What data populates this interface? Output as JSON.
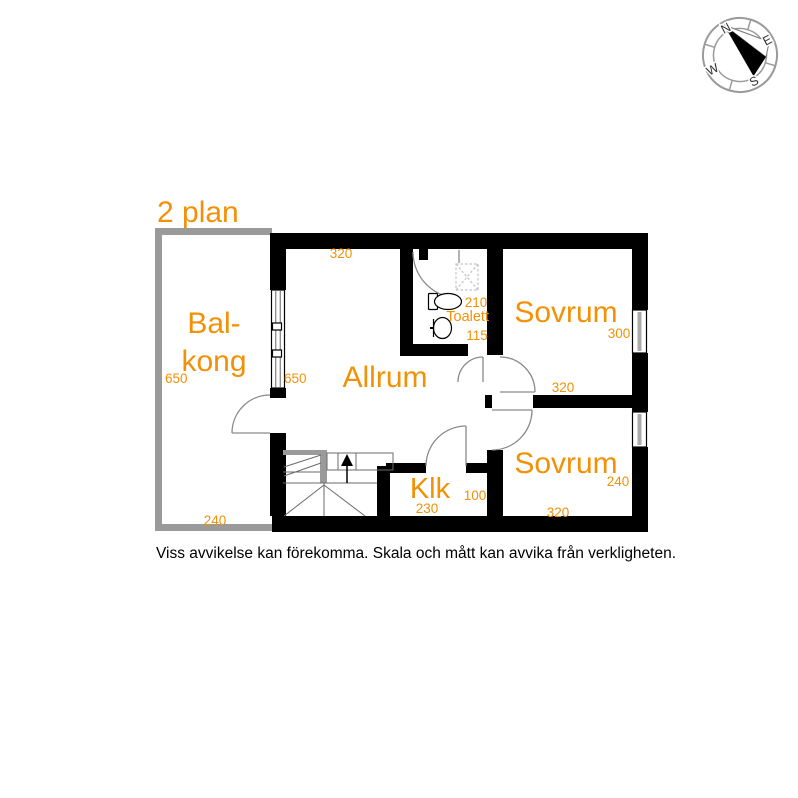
{
  "title": "2 plan",
  "disclaimer": "Viss avvikelse kan förekomma. Skala och mått kan avvika från verkligheten.",
  "compass": {
    "north": "N",
    "east": "E",
    "south": "S",
    "west": "W"
  },
  "colors": {
    "label_orange": "#F29105",
    "wall_black": "#000000",
    "balcony_gray": "#9a9a9a",
    "door_gray": "#8a8a8a"
  },
  "rooms": {
    "balkong": {
      "label_line1": "Bal-",
      "label_line2": "kong",
      "width_cm": "240",
      "depth_cm": "650"
    },
    "allrum": {
      "label": "Allrum",
      "width_cm": "320",
      "depth_cm": "650"
    },
    "toalett": {
      "label": "Toalett",
      "width_cm": "115",
      "depth_cm": "210"
    },
    "sovrum_top": {
      "label": "Sovrum",
      "width_cm": "320",
      "depth_cm": "300"
    },
    "sovrum_bottom": {
      "label": "Sovrum",
      "width_cm": "320",
      "depth_cm": "240"
    },
    "klk": {
      "label": "Klk",
      "width_cm": "230",
      "depth_cm": "100"
    }
  }
}
